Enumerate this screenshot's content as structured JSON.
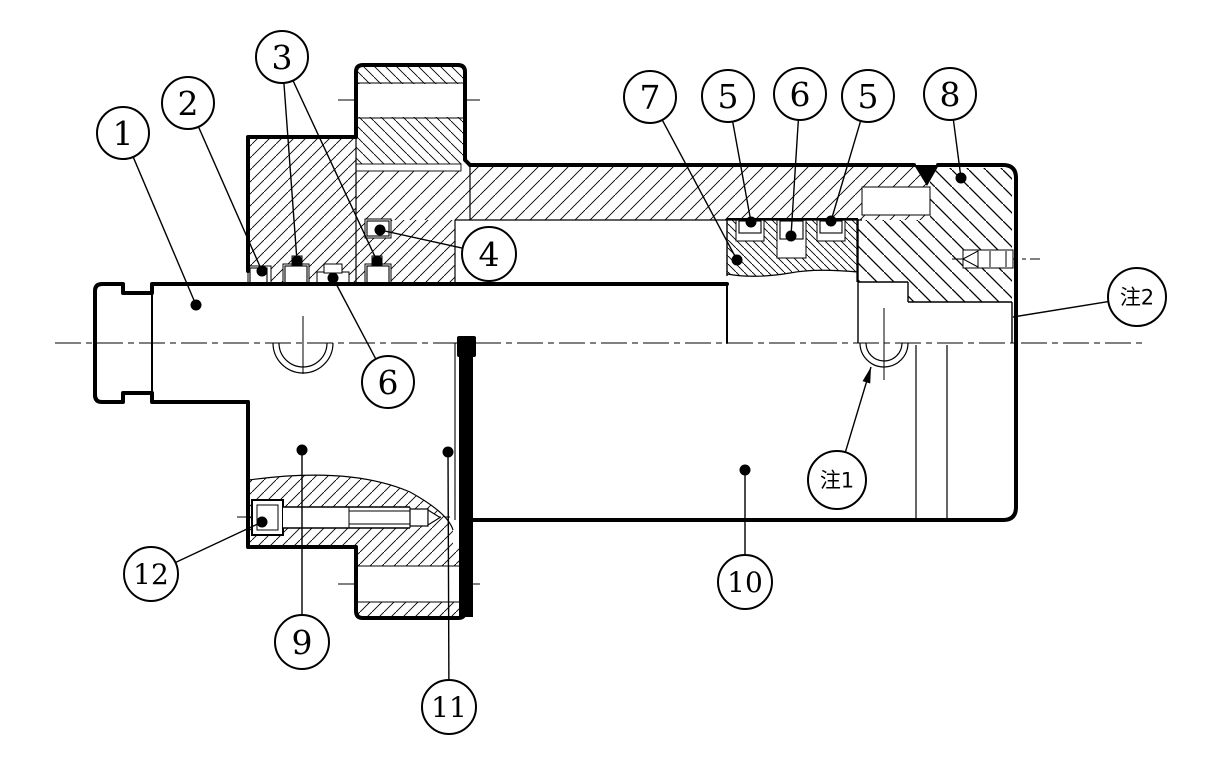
{
  "title": "cylinder-assembly-section-drawing",
  "colors": {
    "line": "#000000",
    "background": "#ffffff"
  },
  "callouts": [
    {
      "label": "1",
      "cx": 123,
      "cy": 133,
      "r": 26,
      "end": "dot",
      "targets": [
        [
          196,
          305
        ]
      ]
    },
    {
      "label": "2",
      "cx": 188,
      "cy": 103,
      "r": 26,
      "end": "dot",
      "targets": [
        [
          262,
          271
        ]
      ]
    },
    {
      "label": "3",
      "cx": 282,
      "cy": 57,
      "r": 26,
      "end": "dot",
      "targets": [
        [
          297,
          261
        ],
        [
          377,
          261
        ]
      ]
    },
    {
      "label": "4",
      "cx": 489,
      "cy": 254,
      "r": 27,
      "end": "dot",
      "targets": [
        [
          380,
          230
        ]
      ]
    },
    {
      "label": "7",
      "cx": 650,
      "cy": 97,
      "r": 26,
      "end": "dot",
      "targets": [
        [
          737,
          260
        ]
      ]
    },
    {
      "label": "5",
      "cx": 728,
      "cy": 96,
      "r": 26,
      "end": "dot",
      "targets": [
        [
          751,
          222
        ]
      ]
    },
    {
      "label": "6",
      "cx": 800,
      "cy": 94,
      "r": 26,
      "end": "dot",
      "targets": [
        [
          791,
          236
        ]
      ]
    },
    {
      "label": "5",
      "cx": 868,
      "cy": 96,
      "r": 26,
      "end": "dot",
      "targets": [
        [
          831,
          221
        ]
      ]
    },
    {
      "label": "8",
      "cx": 950,
      "cy": 94,
      "r": 26,
      "end": "dot",
      "targets": [
        [
          961,
          178
        ]
      ]
    },
    {
      "label": "6",
      "cx": 388,
      "cy": 382,
      "r": 26,
      "end": "dot",
      "targets": [
        [
          333,
          278
        ]
      ]
    },
    {
      "label": "9",
      "cx": 302,
      "cy": 642,
      "r": 27,
      "end": "dot",
      "targets": [
        [
          302,
          450
        ]
      ]
    },
    {
      "label": "10",
      "cx": 745,
      "cy": 582,
      "r": 27,
      "end": "dot",
      "targets": [
        [
          745,
          470
        ]
      ]
    },
    {
      "label": "11",
      "cx": 449,
      "cy": 707,
      "r": 27,
      "end": "dot",
      "targets": [
        [
          448,
          452
        ]
      ]
    },
    {
      "label": "12",
      "cx": 151,
      "cy": 574,
      "r": 27,
      "end": "dot",
      "targets": [
        [
          262,
          522
        ]
      ]
    },
    {
      "label": "注1",
      "cx": 837,
      "cy": 480,
      "r": 29,
      "end": "arrow",
      "targets": [
        [
          871,
          367
        ]
      ],
      "note": true
    },
    {
      "label": "注2",
      "cx": 1137,
      "cy": 297,
      "r": 29,
      "end": "plain",
      "targets": [
        [
          1013,
          317
        ]
      ],
      "note": true
    }
  ]
}
